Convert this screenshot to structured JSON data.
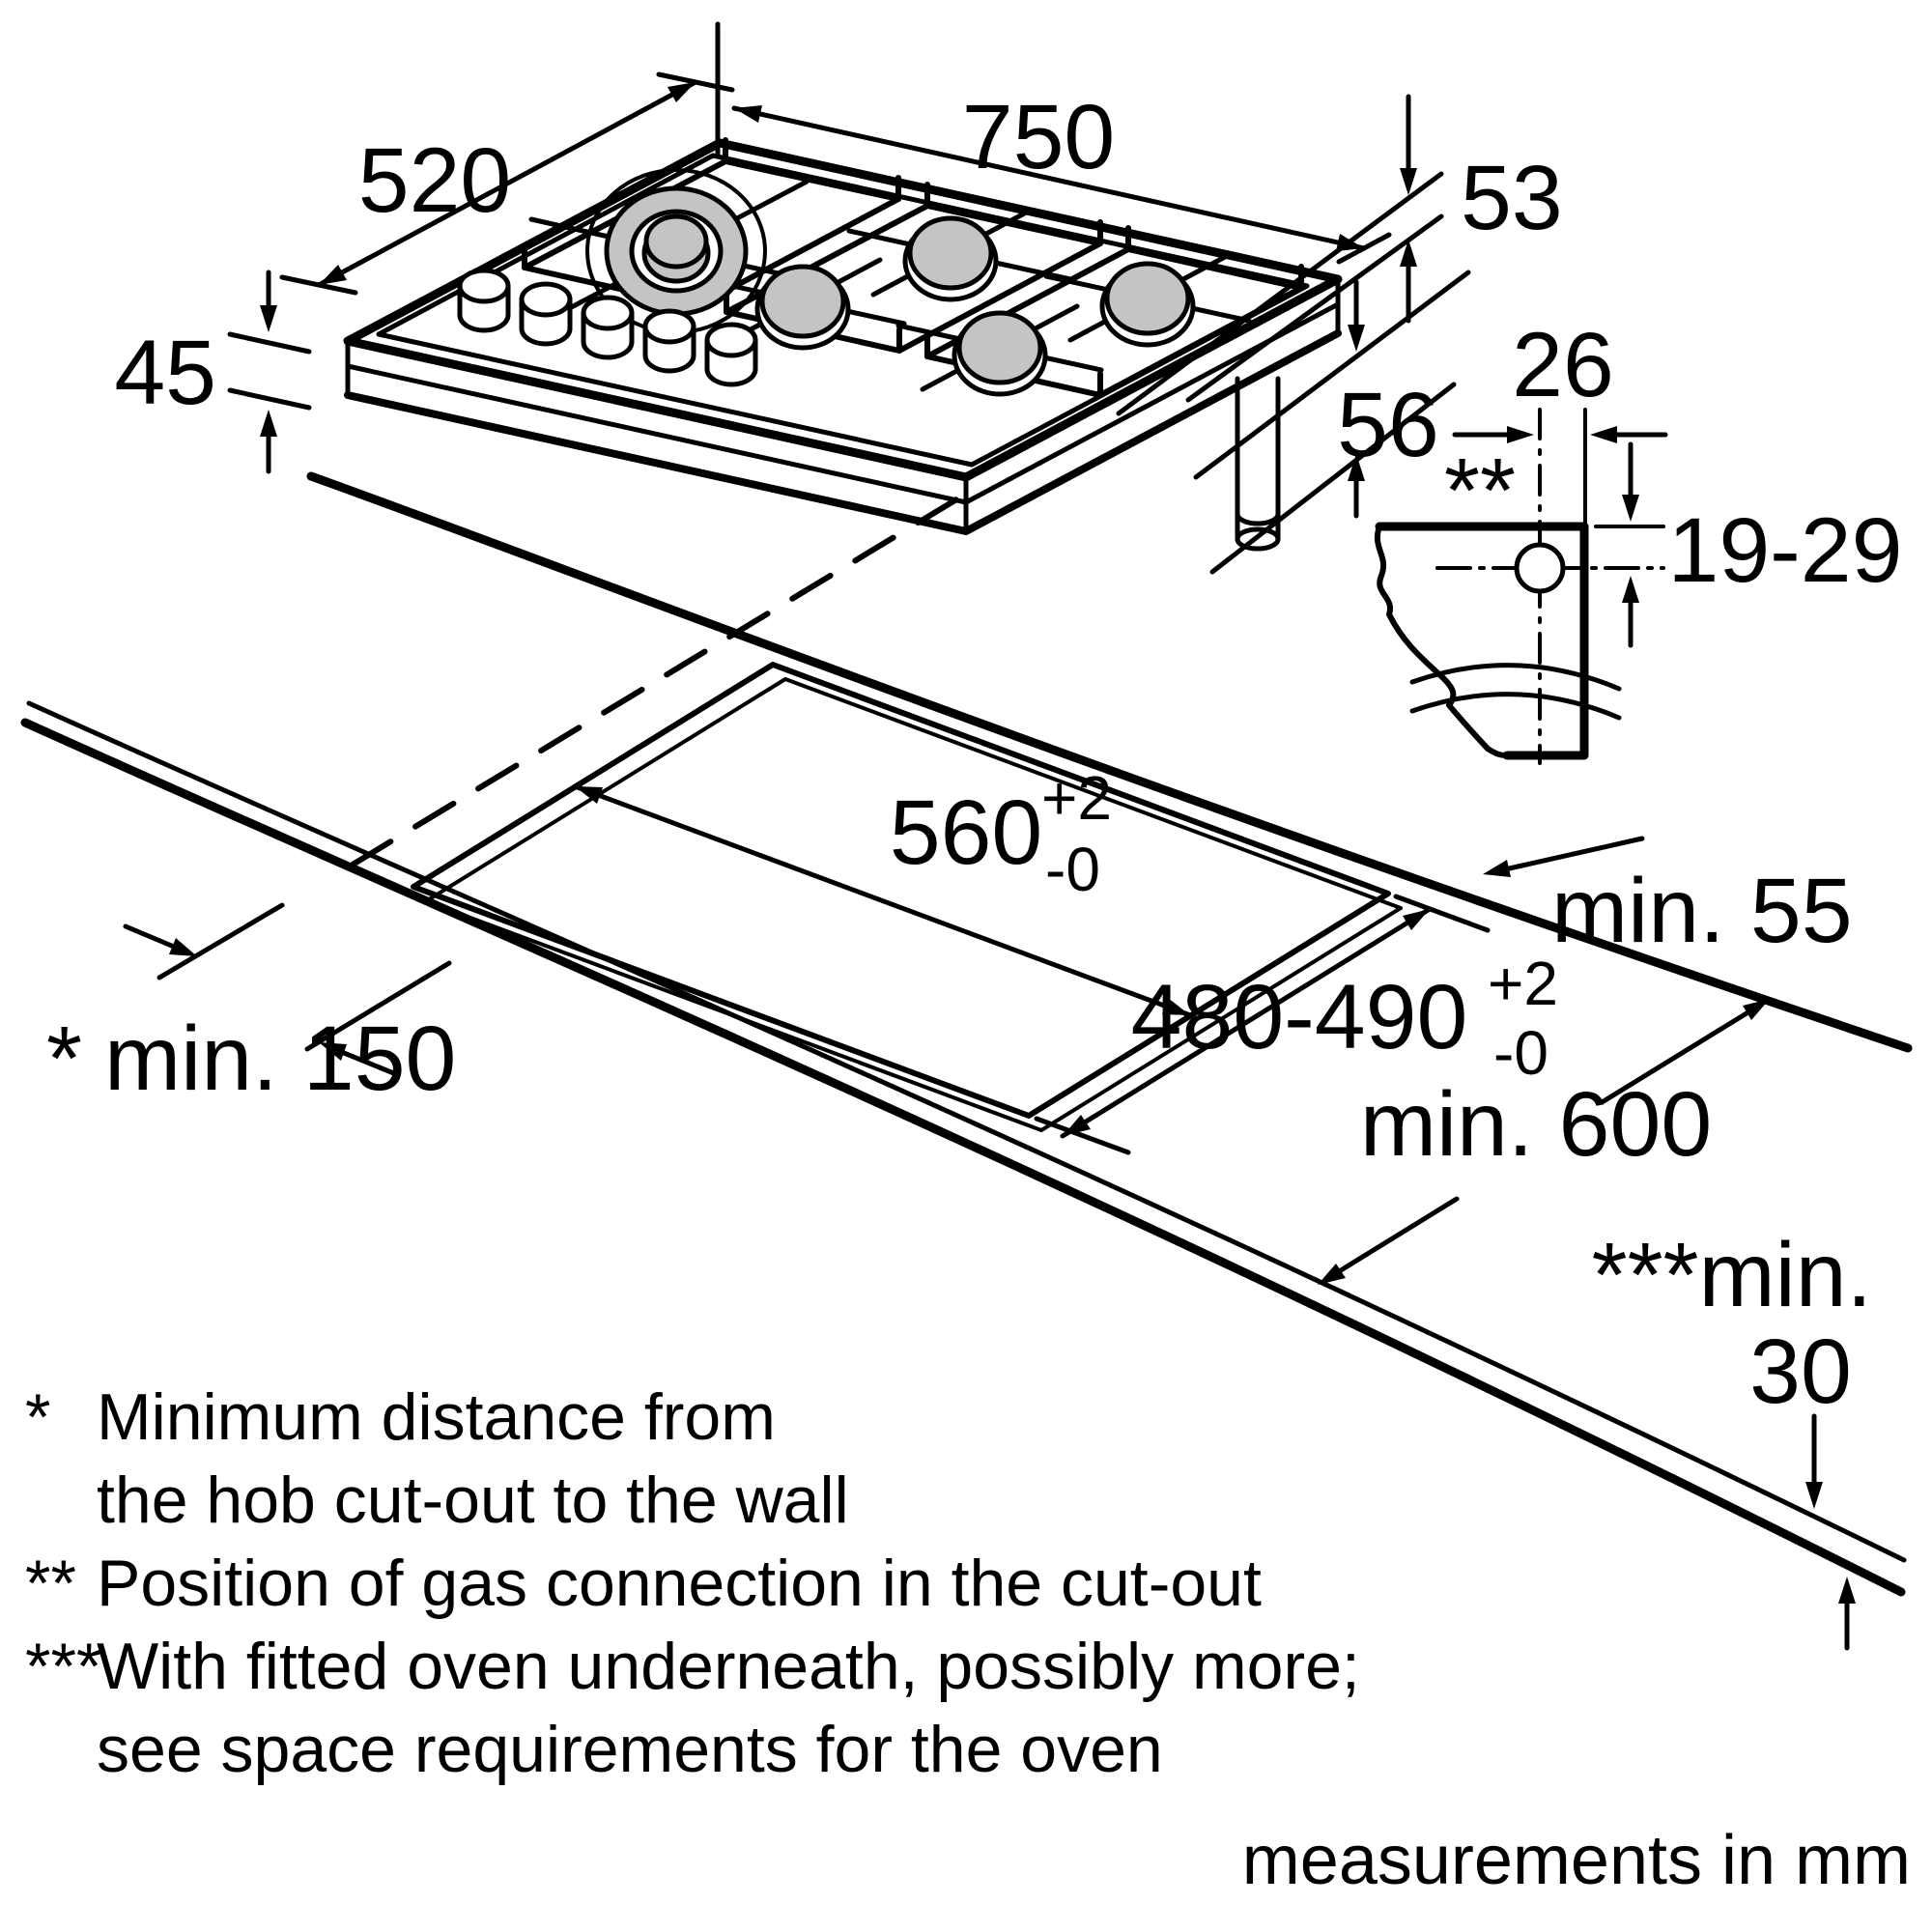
{
  "diagram": {
    "hob": {
      "width": "750",
      "depth": "520",
      "height": "45"
    },
    "gas": {
      "edge_offset": "53",
      "drop": "56",
      "hole_offset": "26",
      "hole_depth": "19-29",
      "marker": "**"
    },
    "cutout": {
      "width": "560",
      "depth": "480-490",
      "tol_plus": "+2",
      "tol_minus": "-0"
    },
    "clearances": {
      "wall_marker": "*",
      "wall": "min. 150",
      "rear": "min. 55",
      "worktop_depth": "min. 600",
      "front_prefix": "***min.",
      "front_value": "30"
    },
    "footnotes": [
      {
        "marker": "*",
        "line1": "Minimum distance from",
        "line2": "the hob cut-out to the wall"
      },
      {
        "marker": "**",
        "line1": "Position of gas connection in the cut-out"
      },
      {
        "marker": "***",
        "line1": "With fitted oven underneath, possibly more;",
        "line2": "see space requirements for the oven"
      }
    ],
    "unit_note": "measurements in mm"
  }
}
